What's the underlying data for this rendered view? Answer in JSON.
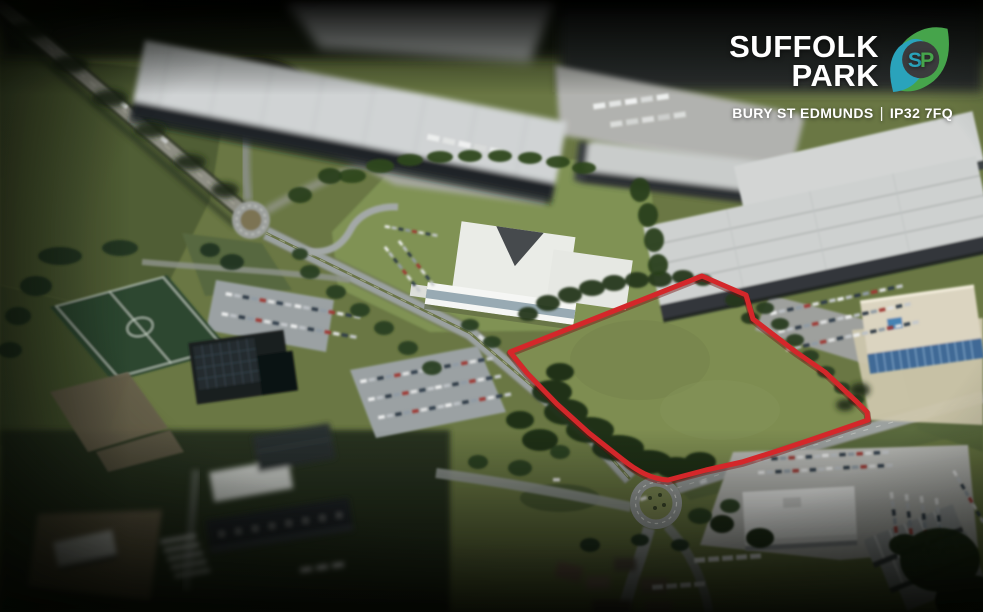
{
  "brand": {
    "name_line1": "SUFFOLK",
    "name_line2": "PARK",
    "monogram_s": "S",
    "monogram_p": "P",
    "location": "BURY ST EDMUNDS",
    "divider": "|",
    "postcode": "IP32 7FQ"
  },
  "colors": {
    "boundary_red": "#d8282b",
    "leaf_green": "#46a44b",
    "leaf_teal": "#2aa3bb",
    "monogram_circle": "#3b3b3d",
    "logo_text": "#ffffff"
  },
  "icons": {
    "logo": "sp-leaf-monogram"
  }
}
